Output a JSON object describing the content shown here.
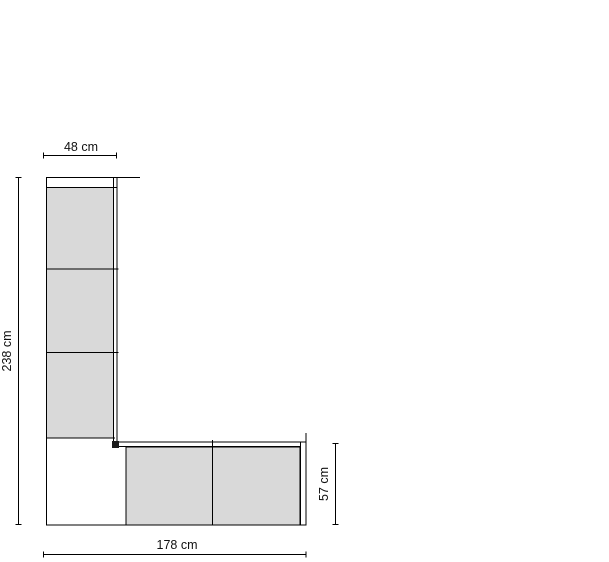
{
  "drawing": {
    "type": "furniture-elevation-dimension-drawing",
    "labels": {
      "top_width": "48 cm",
      "left_height": "238 cm",
      "bottom_width": "178 cm",
      "right_height": "57 cm"
    },
    "structure": {
      "tall_unit_panels": 3,
      "base_unit_panels": 2
    },
    "colors": {
      "panel_fill": "#d9d9d9",
      "outline": "#000000",
      "background": "#ffffff",
      "text": "#111111"
    }
  }
}
